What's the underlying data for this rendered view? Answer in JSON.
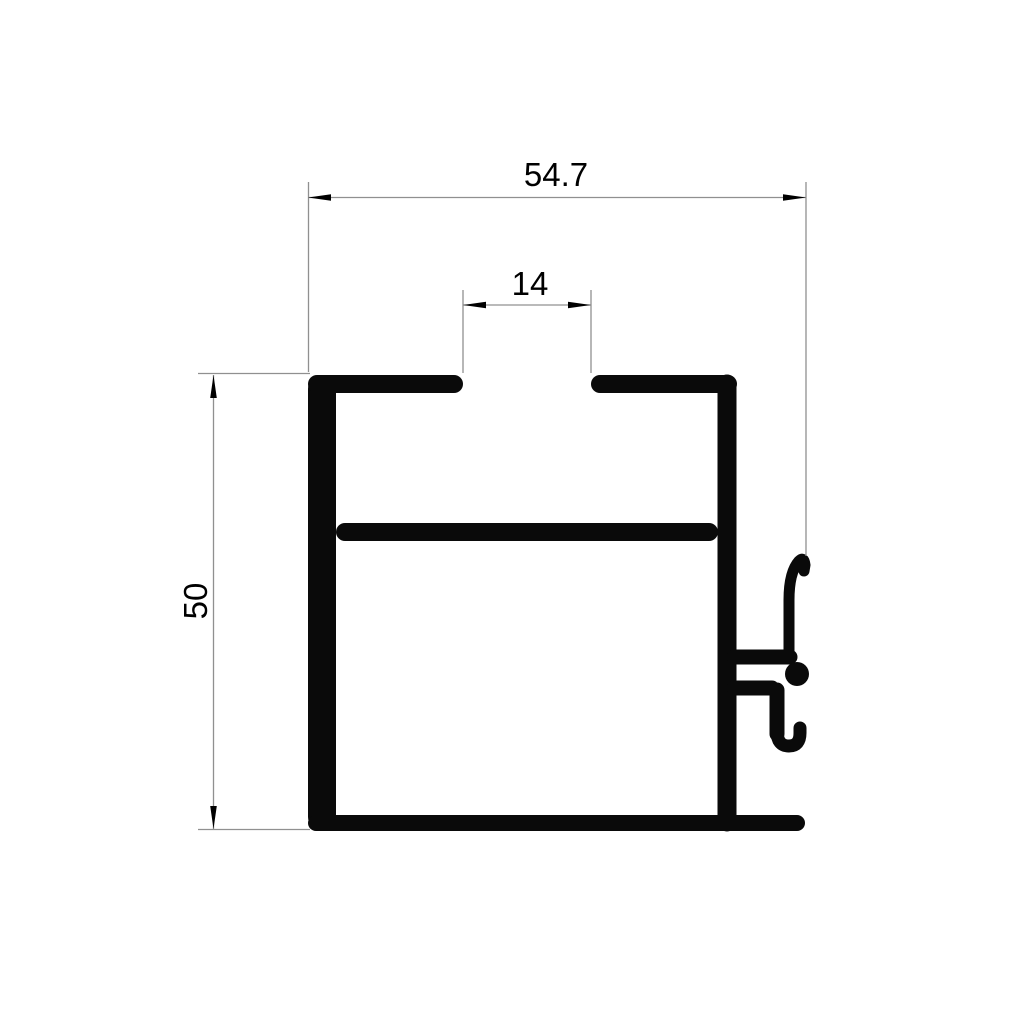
{
  "page": {
    "background_color": "#ffffff",
    "kind": "technical drawing",
    "subject": "aluminium extrusion profile cross-section"
  },
  "colors": {
    "profile_fill": "#0a0a0a",
    "dimension_line": "#909090",
    "arrow_and_text": "#000000"
  },
  "dimensions": {
    "width": {
      "label": "54.7",
      "orientation": "horizontal",
      "position": "top"
    },
    "slot": {
      "label": "14",
      "orientation": "horizontal",
      "position": "top-center"
    },
    "height": {
      "label": "50",
      "orientation": "vertical",
      "position": "left"
    }
  }
}
